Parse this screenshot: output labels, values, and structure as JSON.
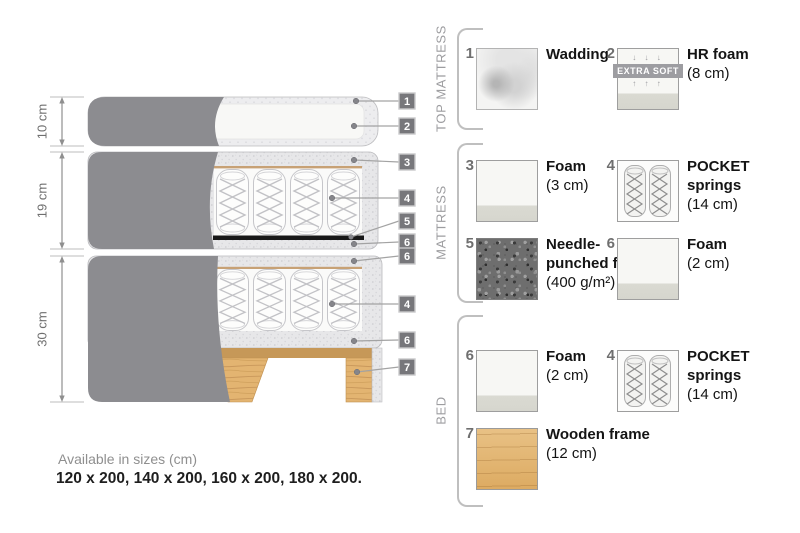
{
  "diagram": {
    "dimensions": [
      {
        "label": "10 cm"
      },
      {
        "label": "19 cm"
      },
      {
        "label": "30 cm"
      }
    ],
    "callouts": [
      {
        "num": "1"
      },
      {
        "num": "2"
      },
      {
        "num": "3"
      },
      {
        "num": "4"
      },
      {
        "num": "5"
      },
      {
        "num": "6"
      },
      {
        "num": "6"
      },
      {
        "num": "4"
      },
      {
        "num": "6"
      },
      {
        "num": "7"
      }
    ]
  },
  "availability": {
    "title": "Available in sizes (cm)",
    "sizes": "120 x 200, 140 x 200, 160 x 200, 180 x 200."
  },
  "legend": {
    "sections": [
      {
        "label": "TOP MATTRESS"
      },
      {
        "label": "MATTRESS"
      },
      {
        "label": "BED"
      }
    ],
    "items": [
      {
        "num": "1",
        "name": "Wadding",
        "size": "",
        "swatch": "wadding"
      },
      {
        "num": "2",
        "name": "HR foam",
        "size": "(8 cm)",
        "swatch": "extra-soft-foam",
        "badge": "EXTRA SOFT",
        "arrows_down": "↓ ↓ ↓",
        "arrows_up": "↑ ↑ ↑"
      },
      {
        "num": "3",
        "name": "Foam",
        "size": "(3 cm)",
        "swatch": "foam"
      },
      {
        "num": "4",
        "name": "POCKET springs",
        "size": "(14 cm)",
        "swatch": "pocket-springs"
      },
      {
        "num": "5",
        "name": "Needle-punched felt",
        "size": "(400 g/m²)",
        "swatch": "felt"
      },
      {
        "num": "6",
        "name": "Foam",
        "size": "(2 cm)",
        "swatch": "foam"
      },
      {
        "num": "6",
        "name": "Foam",
        "size": "(2 cm)",
        "swatch": "foam"
      },
      {
        "num": "4",
        "name": "POCKET springs",
        "size": "(14 cm)",
        "swatch": "pocket-springs"
      },
      {
        "num": "7",
        "name": "Wooden frame",
        "size": "(12 cm)",
        "swatch": "wood"
      }
    ]
  },
  "colors": {
    "cover_grey": "#8c8c90",
    "speckle_foam": "#e7e7e9",
    "wood": "#e0b26e",
    "rail_tan": "#c69858",
    "felt_black": "#181818",
    "badge_grey": "#77777b"
  }
}
